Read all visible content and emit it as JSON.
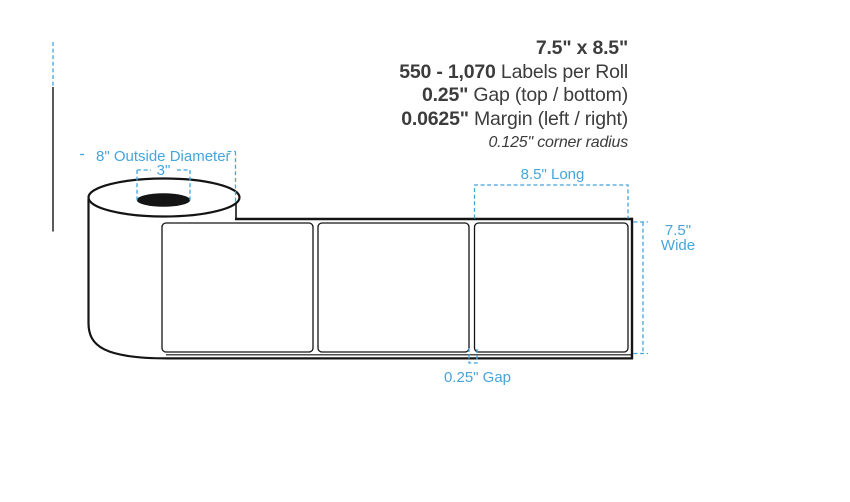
{
  "colors": {
    "accent_blue": "#45A5DC",
    "ink_text": "#3C3C3C",
    "line_black": "#141414"
  },
  "spec_block": {
    "size": "7.5\" x 8.5\"",
    "count_bold": "550 - 1,070",
    "count_rest": "Labels per Roll",
    "gap_bold": "0.25\"",
    "gap_rest": "Gap (top / bottom)",
    "margin_bold": "0.0625\"",
    "margin_rest": "Margin (left / right)",
    "radius_italic": "0.125\" corner radius"
  },
  "dimension_labels": {
    "outside_diameter": "8\" Outside Diameter",
    "core_diameter": "3\"",
    "label_length": "8.5\" Long",
    "label_width_line1": "7.5\"",
    "label_width_line2": "Wide",
    "label_gap": "0.25\" Gap"
  },
  "diagram": {
    "label_count": 3
  }
}
